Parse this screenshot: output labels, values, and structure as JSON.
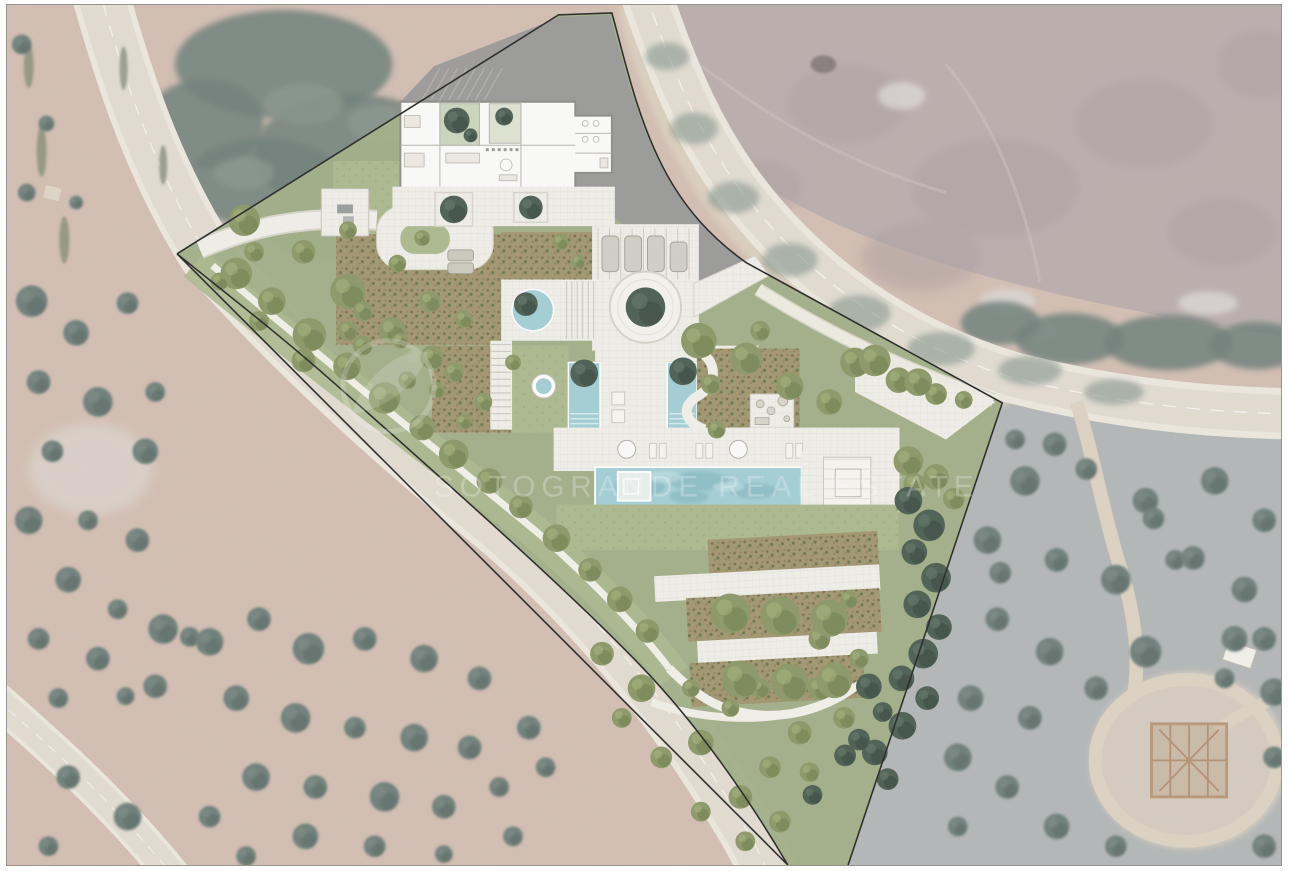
{
  "scene": {
    "title": "Landscaped villa masterplan overlaid on aerial photograph",
    "type": "architectural-site-plan-overlay",
    "watermark": {
      "text": "SOTOGRANDE REAL ESTATE",
      "logo_icon": "leaf-circle-logo"
    }
  },
  "palette": {
    "aerial_scrub_pink": "#c8b4a8",
    "aerial_field_pink": "#cdb6a9",
    "aerial_forest_dark": "#5d6f6a",
    "aerial_hill_mauve": "#b2a4a4",
    "aerial_gray_scrub": "#a9aeae",
    "road_shoulder": "#eae5da",
    "road_asphalt": "#ded7cb",
    "dirt_track": "#d8cdbc",
    "plan_lawn": "#adba90",
    "plan_meadow": "#a2b089",
    "plan_bed": "#a39872",
    "plan_paving": "#f0efe9",
    "plan_water": "#a5cfd6",
    "plan_pool_deep": "#8fbec6",
    "plan_gray": "#9b9b9b",
    "tree_olive": "#8d9a6a",
    "tree_dark": "#4f6156",
    "boundary": "#2b2b2b",
    "building_wall": "#8f8f8a",
    "pergola_wood": "#b08c68",
    "watermark_white": "#ffffff"
  }
}
